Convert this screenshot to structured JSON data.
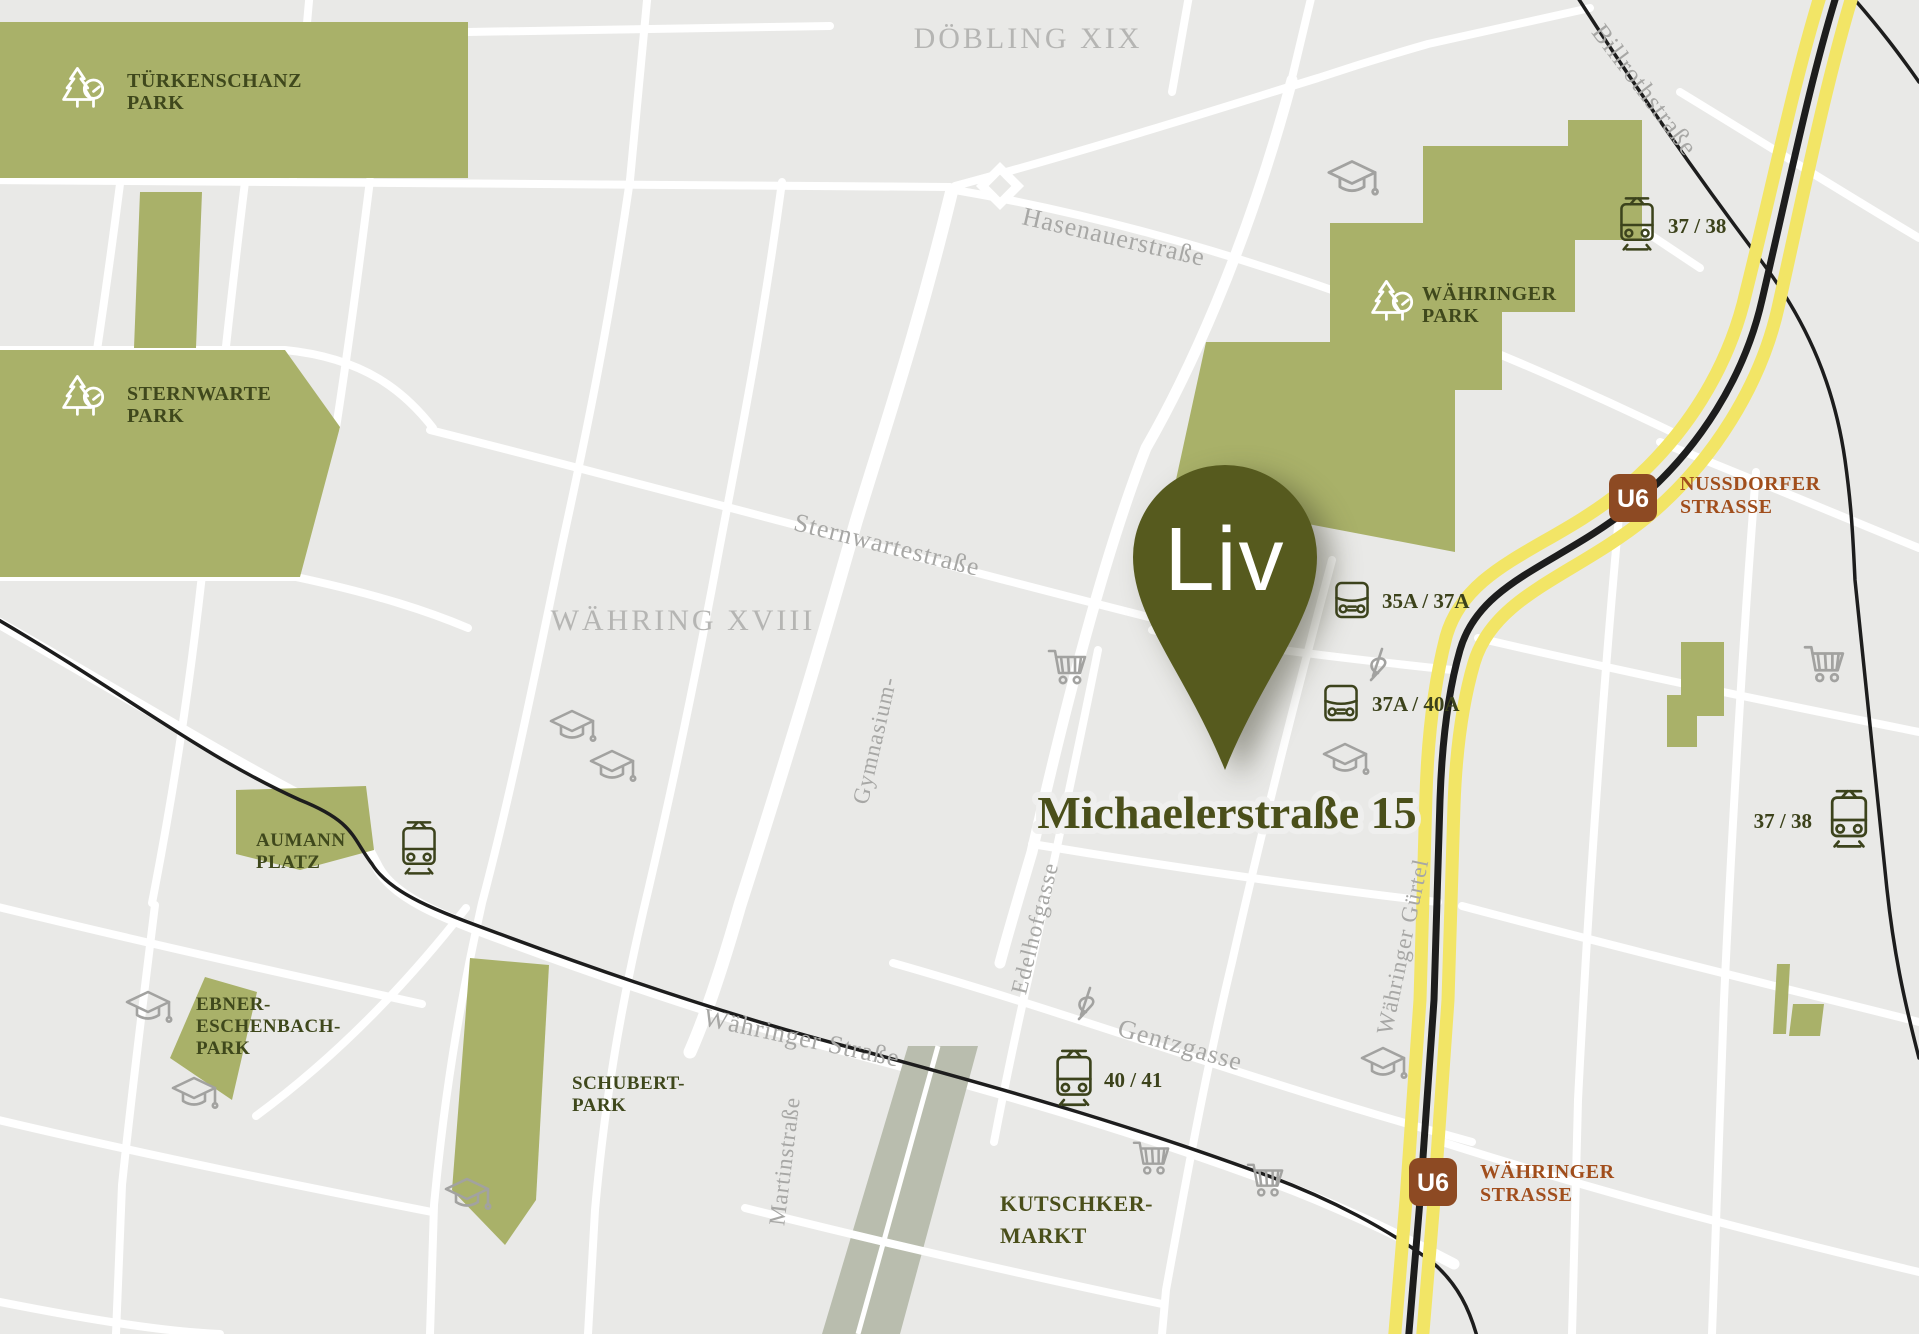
{
  "marker": {
    "name": "Liv",
    "address": "Michaelerstraße 15"
  },
  "districts": [
    {
      "label": "DÖBLING XIX"
    },
    {
      "label": "WÄHRING XVIII"
    }
  ],
  "parks": [
    {
      "id": "tuerkenschanz-park",
      "lines": [
        "TÜRKENSCHANZ",
        "PARK"
      ]
    },
    {
      "id": "sternwarte-park",
      "lines": [
        "STERNWARTE",
        "PARK"
      ]
    },
    {
      "id": "waehringer-park",
      "lines": [
        "WÄHRINGER",
        "PARK"
      ]
    },
    {
      "id": "aumann-platz",
      "lines": [
        "AUMANN",
        "PLATZ"
      ]
    },
    {
      "id": "ebner-eschenbach-park",
      "lines": [
        "EBNER-",
        "ESCHENBACH-",
        "PARK"
      ]
    },
    {
      "id": "schubert-park",
      "lines": [
        "SCHUBERT-",
        "PARK"
      ]
    }
  ],
  "market": {
    "lines": [
      "KUTSCHKER-",
      "MARKT"
    ]
  },
  "streets": [
    {
      "label": "Hasenauerstraße"
    },
    {
      "label": "Sternwartestraße"
    },
    {
      "label": "Gymnasium-"
    },
    {
      "label": "Billrothstraße"
    },
    {
      "label": "Währinger Straße"
    },
    {
      "label": "Gentzgasse"
    },
    {
      "label": "Edelhofgasse"
    },
    {
      "label": "Martinstraße"
    },
    {
      "label": "Währinger Gürtel"
    }
  ],
  "stations": [
    {
      "line": "U6",
      "name_lines": [
        "NUSSDORFER",
        "STRASSE"
      ]
    },
    {
      "line": "U6",
      "name_lines": [
        "WÄHRINGER",
        "STRASSE"
      ]
    }
  ],
  "stops": [
    {
      "type": "tram",
      "label": "37 / 38"
    },
    {
      "type": "bus",
      "label": "35A / 37A"
    },
    {
      "type": "bus",
      "label": "37A / 40A"
    },
    {
      "type": "tram",
      "label": "37 / 38"
    },
    {
      "type": "tram",
      "label": "40 / 41"
    }
  ],
  "icons": {
    "park": "trees-icon",
    "tram": "tram-icon",
    "bus": "bus-icon",
    "supermarket": "shopping-cart-icon",
    "school": "graduation-cap-icon",
    "music": "music-note-icon"
  },
  "colors": {
    "map_bg": "#e9e9e7",
    "street_white": "#ffffff",
    "park_green": "#a9b169",
    "pin_olive": "#565a1e",
    "label_olive": "#3f481c",
    "address_olive": "#4a4f1a",
    "u6_yellow": "#f2e566",
    "rail_black": "#1d1d1d",
    "u6_badge_brown": "#8d4a23",
    "station_text_brown": "#a14e1c",
    "muted_gray": "#a7a7a5",
    "market_strip": "#b9bdae"
  }
}
